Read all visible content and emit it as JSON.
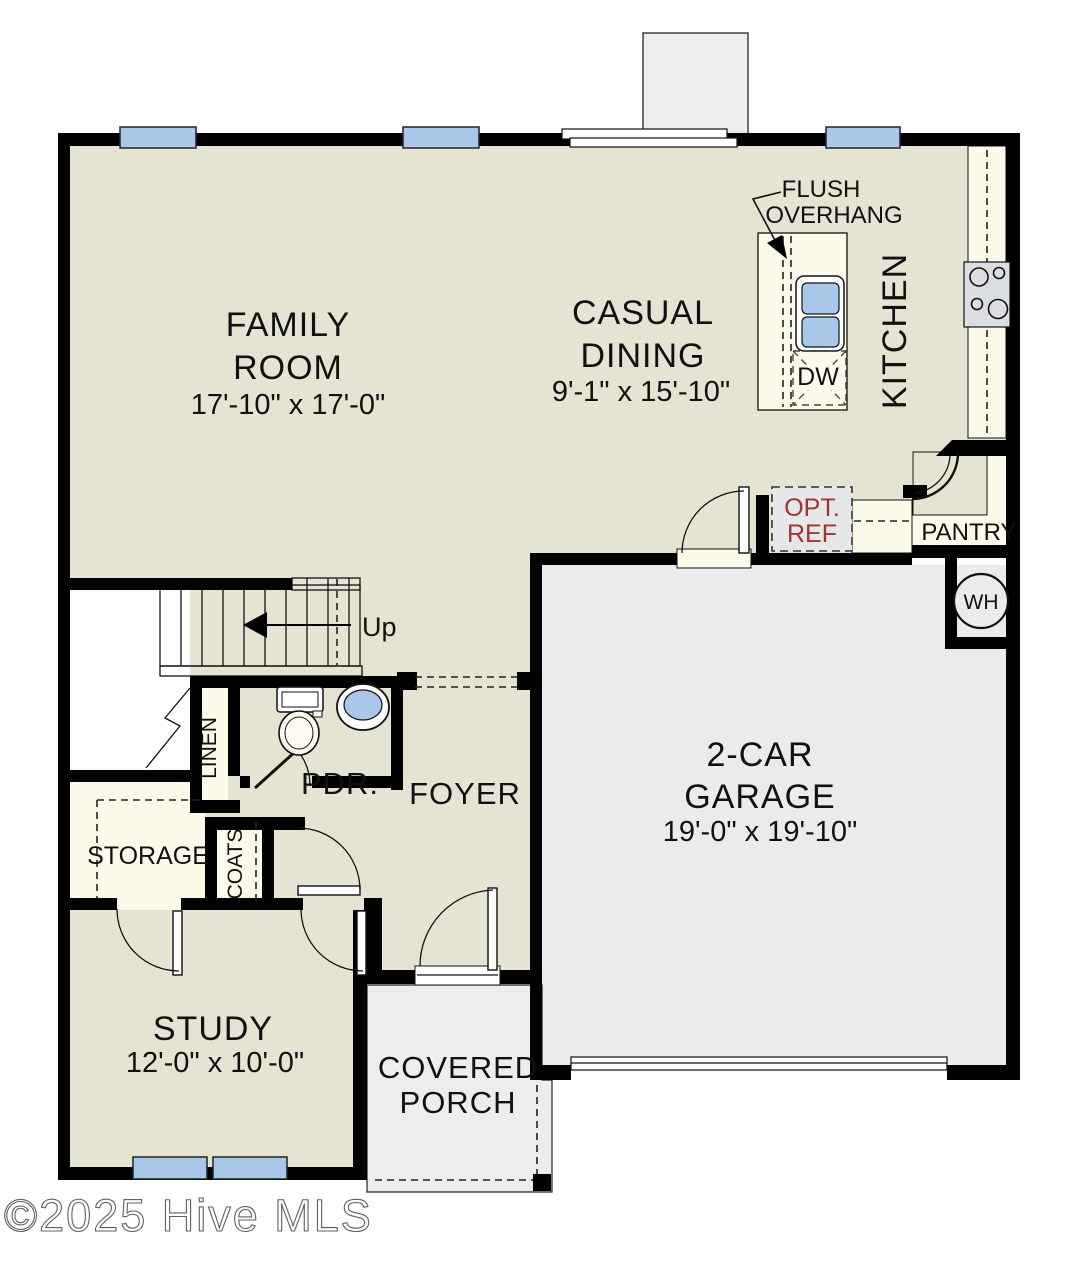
{
  "colors": {
    "floor_beige": "#E5E3D2",
    "cabinet_cream": "#FCFAE9",
    "garage_gray": "#E9EBED",
    "porch_gray": "#EBEDEF",
    "window_blue": "#A9C7E8",
    "appliance_gray": "#DADDE2",
    "wall_black": "#000000",
    "annotation_red": "#A03530",
    "watermark_gray": "#5F5F5F"
  },
  "rooms": {
    "family_room": {
      "line1": "FAMILY",
      "line2": "ROOM",
      "dims": "17'-10\" x 17'-0\""
    },
    "casual_dining": {
      "line1": "CASUAL",
      "line2": "DINING",
      "dims": "9'-1\" x 15'-10\""
    },
    "kitchen": {
      "label": "KITCHEN"
    },
    "pantry": {
      "label": "PANTRY"
    },
    "garage": {
      "line1": "2-CAR",
      "line2": "GARAGE",
      "dims": "19'-0\" x 19'-10\""
    },
    "foyer": {
      "label": "FOYER"
    },
    "powder_room": {
      "label": "PDR."
    },
    "linen": {
      "label": "LINEN"
    },
    "coats": {
      "label": "COATS"
    },
    "storage": {
      "label": "STORAGE"
    },
    "study": {
      "line1": "STUDY",
      "dims": "12'-0\" x 10'-0\""
    },
    "covered_porch": {
      "line1": "COVERED",
      "line2": "PORCH"
    }
  },
  "labels": {
    "flush_overhang": {
      "line1": "FLUSH",
      "line2": "OVERHANG"
    },
    "dishwasher": "DW",
    "optional_refrigerator": {
      "line1": "OPT.",
      "line2": "REF"
    },
    "water_heater": "WH",
    "stairs_up": "Up"
  },
  "watermark": "©2025 Hive MLS"
}
